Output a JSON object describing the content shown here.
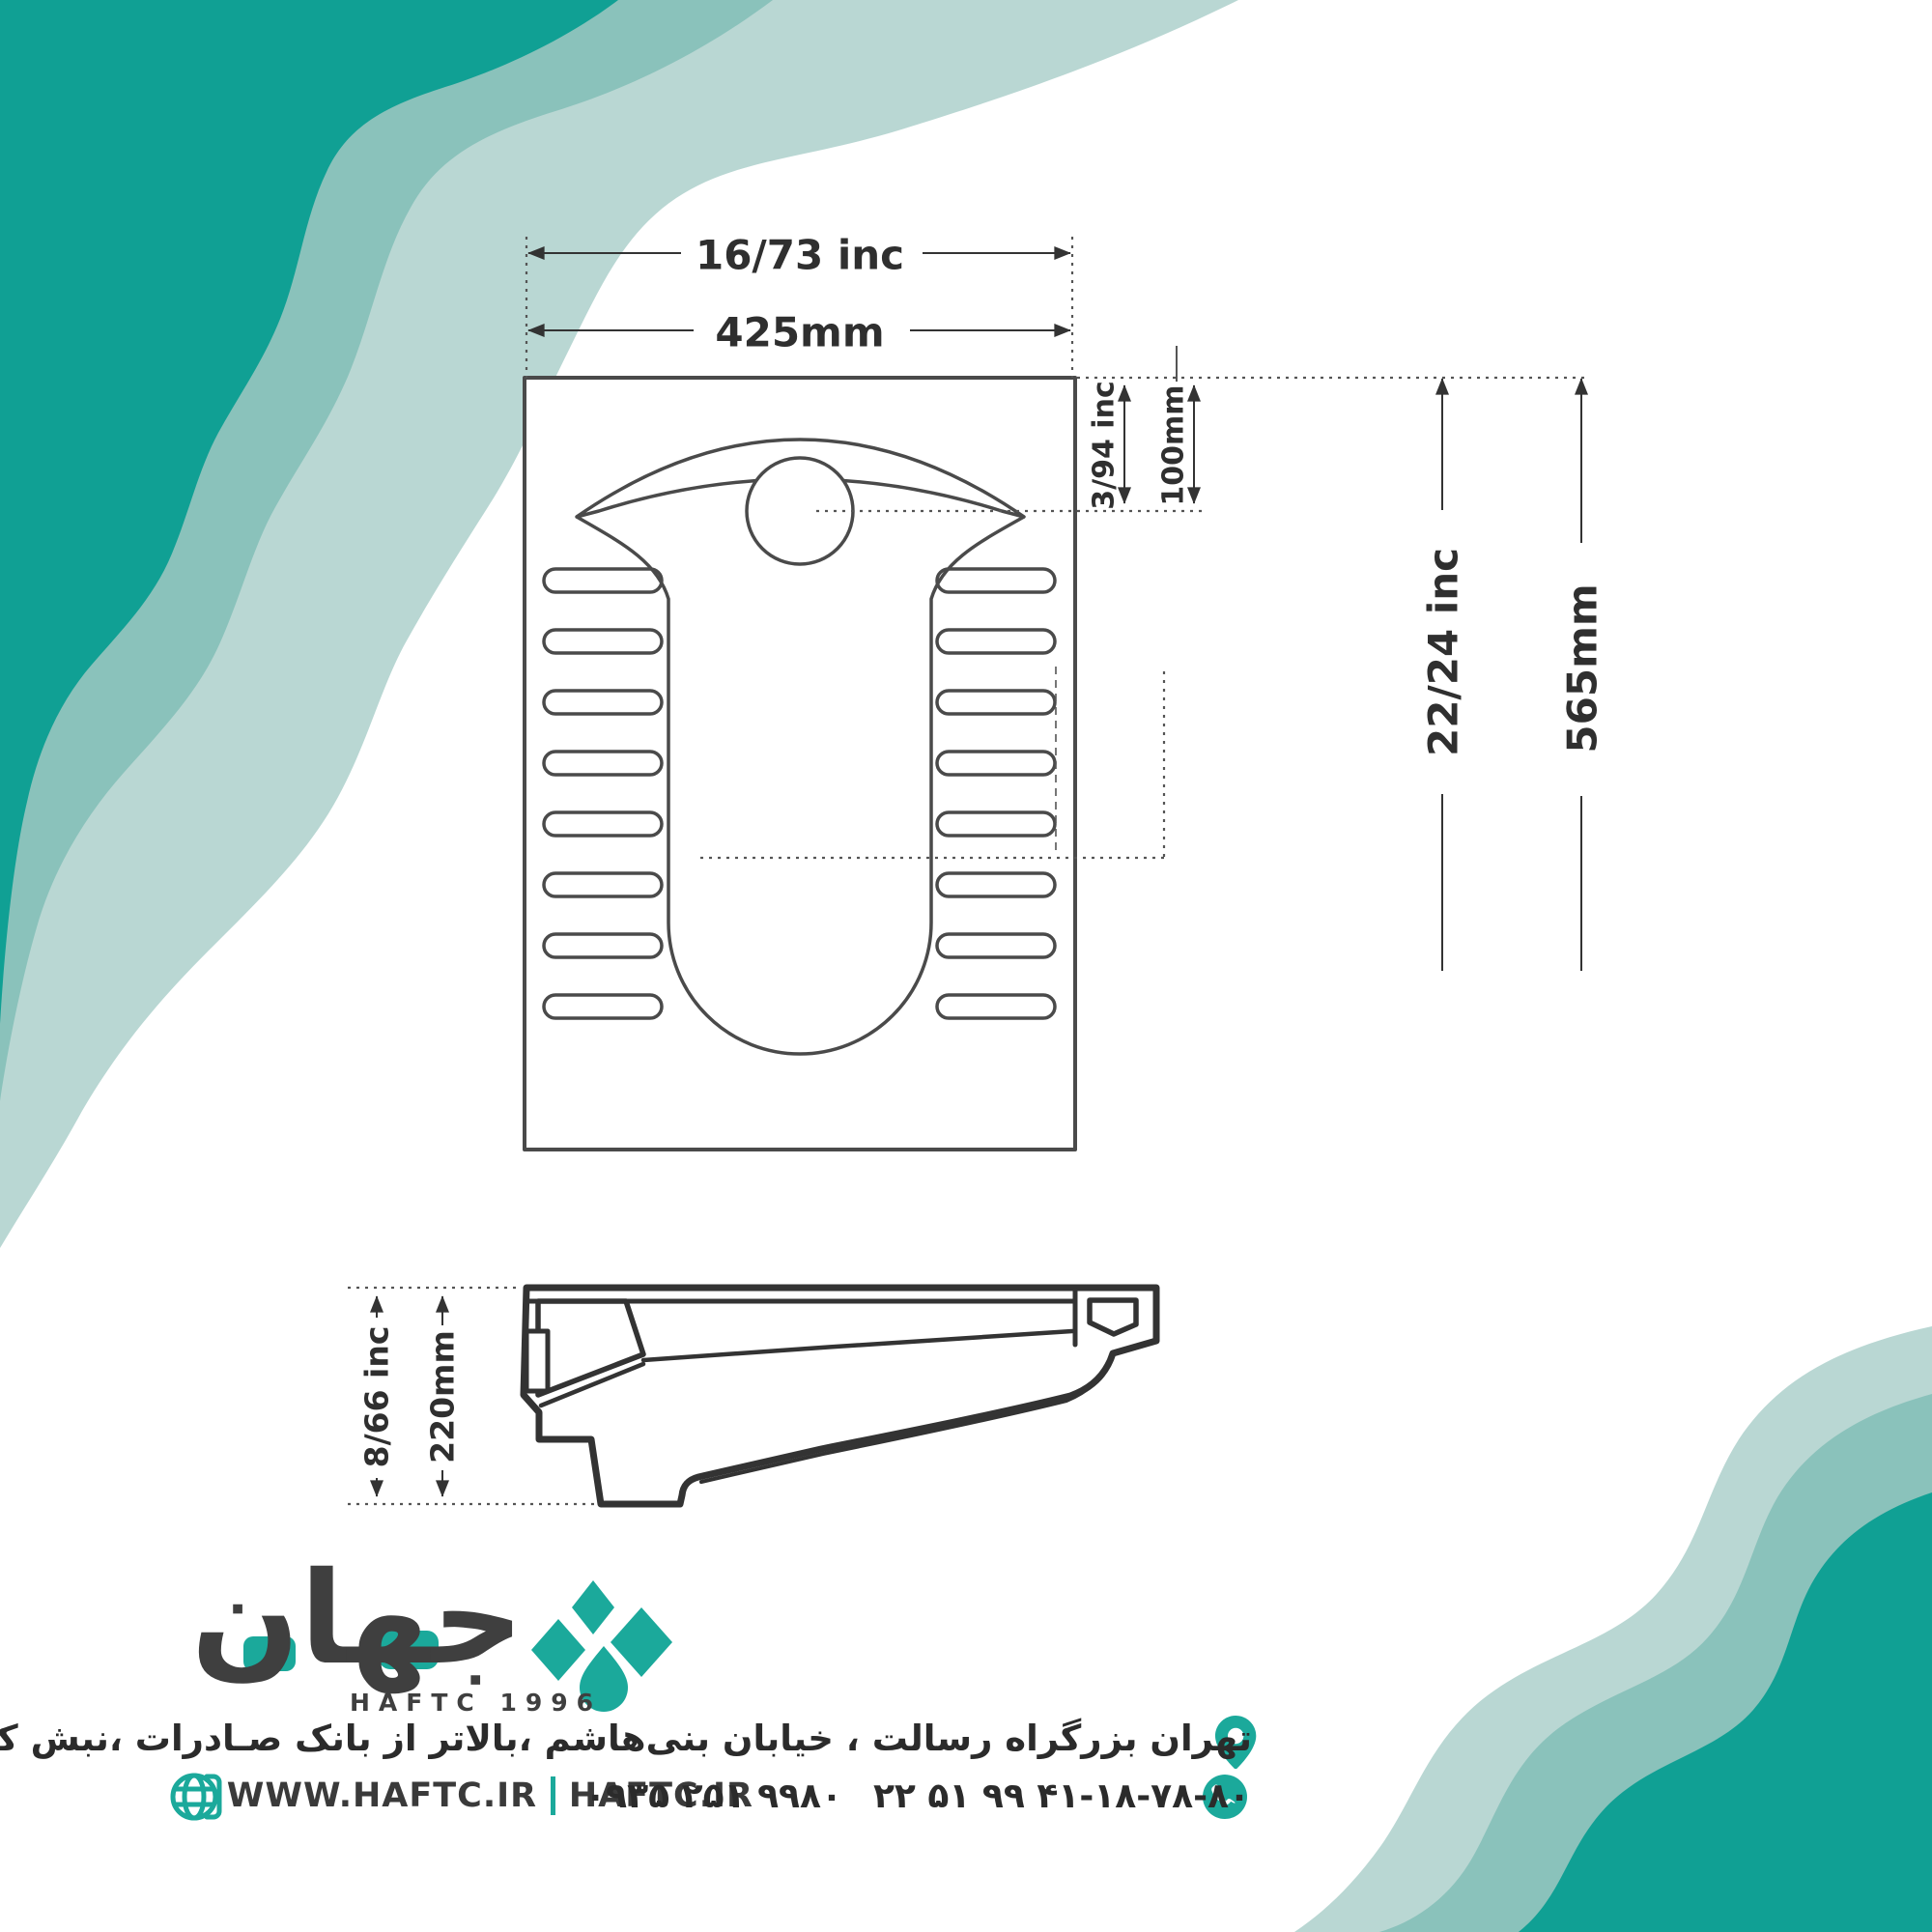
{
  "colors": {
    "teal_dark": "#10a094",
    "teal_medium": "#8ac2bb",
    "teal_light": "#b9d7d3",
    "brand_teal": "#1ba99b",
    "ink": "#3a3a3a",
    "line": "#4a4a4a"
  },
  "brand": {
    "wordmark": "جهان",
    "tagline": "HAFTC 1996"
  },
  "drawing": {
    "top_view": {
      "width_inch": "16/73 inc",
      "width_mm": "425mm",
      "drain_offset_inch": "3/94 inc",
      "drain_offset_mm": "100mm",
      "depth_inch": "22/24 inc",
      "depth_mm": "565mm"
    },
    "side_view": {
      "height_inch": "8/66 inc",
      "height_mm": "220mm"
    }
  },
  "contact": {
    "address": "تهران بزرگراه رسالت ، خیابان بنی‌هاشم ،بالاتر از بانک صـادرات ،نبش کوچه میرهاشـمیان ،پلاک۲۳۷",
    "website_www": "WWW.HAFTC.IR",
    "website_domain": "HAFTC.IR",
    "phone_mobile": "۰۹۳۵ ۲۵۱ ۹۹۸۰",
    "phone_landline": "۲۲ ۵۱ ۹۹ ۴۱-۱۸-۷۸-۸۰"
  },
  "icons": {
    "location": "location-pin-icon",
    "globe": "globe-icon",
    "phone": "phone-icon"
  }
}
